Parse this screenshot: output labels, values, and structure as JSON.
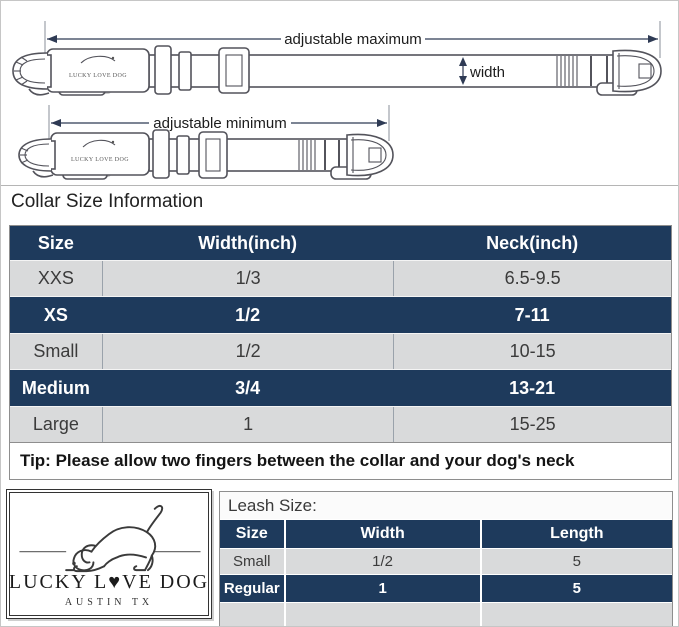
{
  "colors": {
    "navy": "#1e3a5c",
    "light_row": "#d9dadb",
    "dim": "#2e3a54"
  },
  "diagram": {
    "max_label": "adjustable maximum",
    "min_label": "adjustable minimum",
    "width_label": "width",
    "buckle_label": "LUCKY LOVE DOG"
  },
  "collar_section": {
    "heading": "Collar Size Information",
    "table": {
      "headers": [
        "Size",
        "Width(inch)",
        "Neck(inch)"
      ],
      "rows": [
        {
          "size": "XXS",
          "width": "1/3",
          "neck": "6.5-9.5"
        },
        {
          "size": "XS",
          "width": "1/2",
          "neck": "7-11"
        },
        {
          "size": "Small",
          "width": "1/2",
          "neck": "10-15"
        },
        {
          "size": "Medium",
          "width": "3/4",
          "neck": "13-21"
        },
        {
          "size": "Large",
          "width": "1",
          "neck": "15-25"
        }
      ],
      "tip": "Tip: Please allow two fingers between the collar and your dog's neck"
    }
  },
  "logo": {
    "brand": "LUCKY L♥VE DOG",
    "location": "AUSTIN TX"
  },
  "leash_section": {
    "heading": "Leash Size:",
    "table": {
      "headers": [
        "Size",
        "Width",
        "Length"
      ],
      "rows": [
        {
          "size": "Small",
          "width": "1/2",
          "length": "5"
        },
        {
          "size": "Regular",
          "width": "1",
          "length": "5"
        }
      ]
    }
  }
}
